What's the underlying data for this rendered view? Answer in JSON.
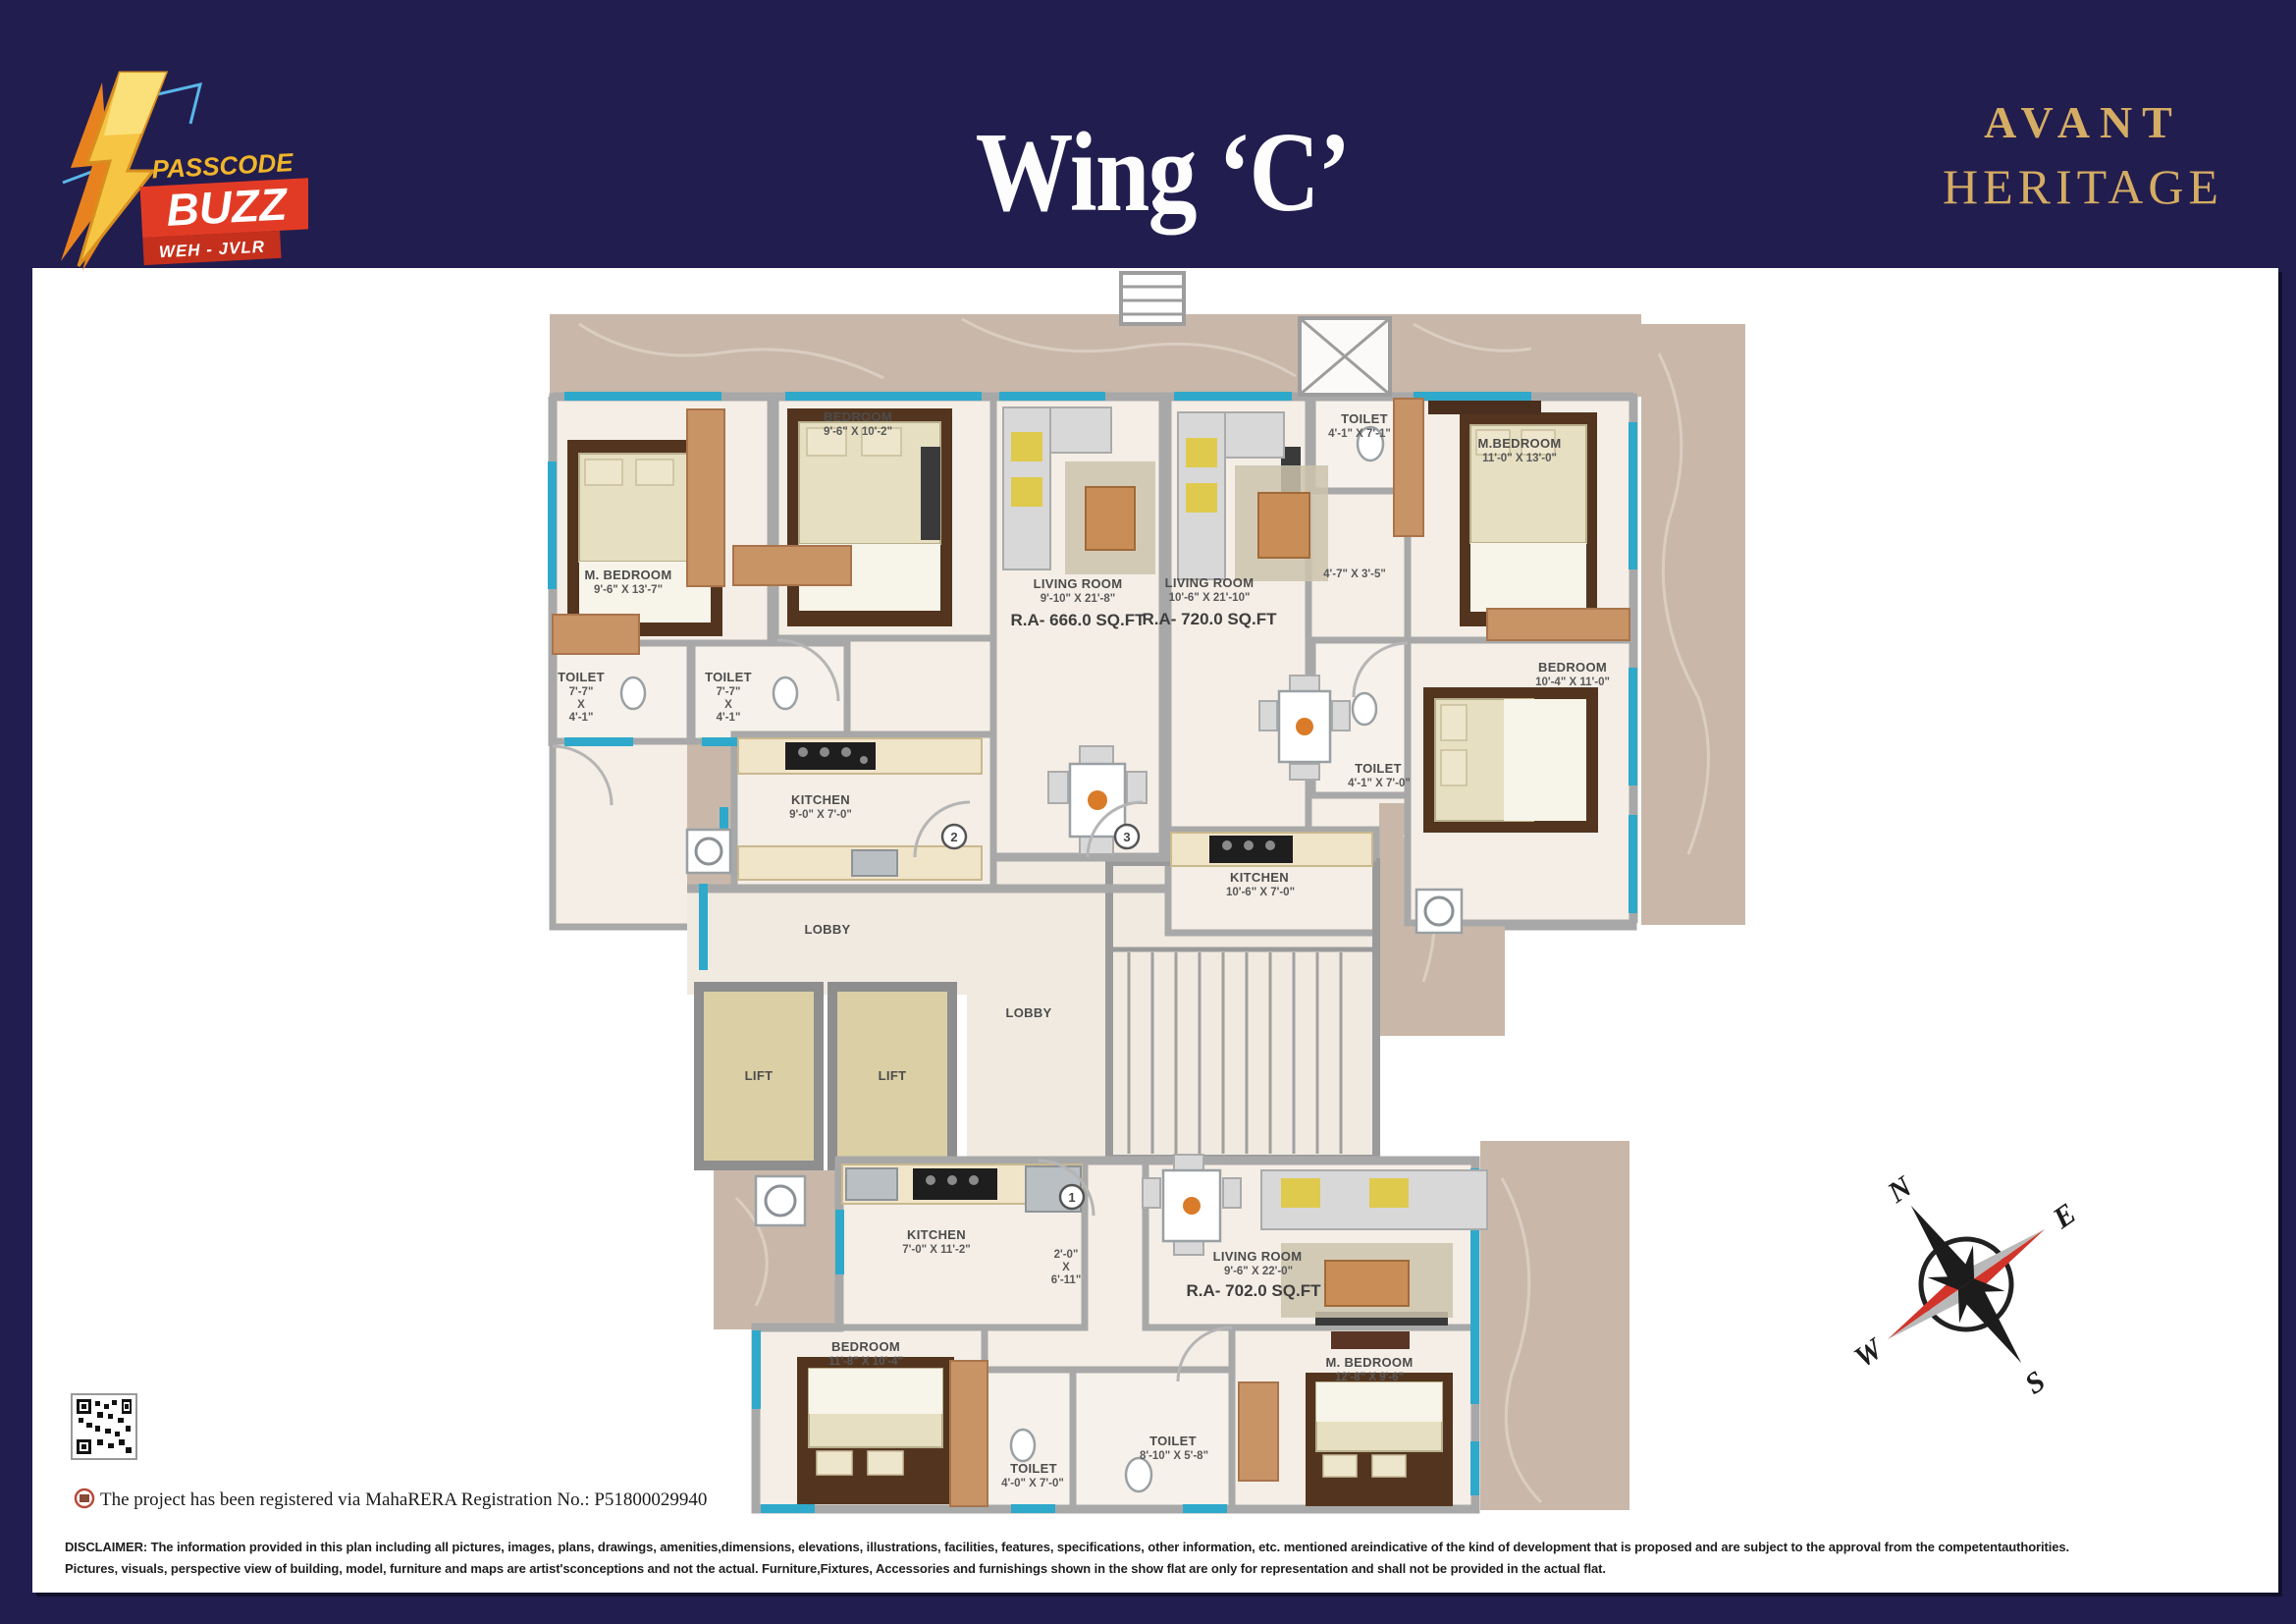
{
  "header": {
    "logo": {
      "passcode": "PASSCODE",
      "buzz": "BUZZ",
      "weh": "WEH - JVLR"
    },
    "title": "Wing ‘C’",
    "brand": {
      "avant": "AVANT",
      "heritage": "HERITAGE"
    }
  },
  "floorplan": {
    "rooms": {
      "m_bedroom_a": {
        "label": "M. BEDROOM",
        "dim": "9'-6\" X 13'-7\""
      },
      "bedroom_a": {
        "label": "BEDROOM",
        "dim": "9'-6\" X 10'-2\""
      },
      "living_a": {
        "label": "LIVING ROOM",
        "dim": "9'-10\" X 21'-8\"",
        "area": "R.A- 666.0 SQ.FT"
      },
      "toilet_a1": {
        "label": "TOILET",
        "w": "7'-7\"",
        "x": "X",
        "h": "4'-1\""
      },
      "toilet_a2": {
        "label": "TOILET",
        "w": "7'-7\"",
        "x": "X",
        "h": "4'-1\""
      },
      "kitchen_a": {
        "label": "KITCHEN",
        "dim": "9'-0\" X 7'-0\""
      },
      "living_b": {
        "label": "LIVING ROOM",
        "dim": "10'-6\" X 21'-10\"",
        "area": "R.A- 720.0 SQ.FT"
      },
      "toilet_b1": {
        "label": "TOILET",
        "dim": "4'-1\" X 7'-1\""
      },
      "passage_b": {
        "dim": "4'-7\" X 3'-5\""
      },
      "m_bedroom_b": {
        "label": "M.BEDROOM",
        "dim": "11'-0\" X 13'-0\""
      },
      "bedroom_b": {
        "label": "BEDROOM",
        "dim": "10'-4\" X 11'-0\""
      },
      "toilet_b2": {
        "label": "TOILET",
        "dim": "4'-1\" X 7'-0\""
      },
      "kitchen_b": {
        "label": "KITCHEN",
        "dim": "10'-6\" X 7'-0\""
      },
      "lobby_a": {
        "label": "LOBBY"
      },
      "lobby_b": {
        "label": "LOBBY"
      },
      "lift_1": {
        "label": "LIFT"
      },
      "lift_2": {
        "label": "LIFT"
      },
      "kitchen_c": {
        "label": "KITCHEN",
        "dim": "7'-0\" X 11'-2\""
      },
      "passage_c": {
        "w": "2'-0\"",
        "x": "X",
        "h": "6'-11\""
      },
      "living_c": {
        "label": "LIVING ROOM",
        "dim": "9'-6\" X 22'-0\"",
        "area": "R.A- 702.0 SQ.FT"
      },
      "bedroom_c": {
        "label": "BEDROOM",
        "dim": "11'-8\" X 10'-4\""
      },
      "toilet_c1": {
        "label": "TOILET",
        "dim": "4'-0\" X 7'-0\""
      },
      "toilet_c2": {
        "label": "TOILET",
        "dim": "8'-10\" X 5'-8\""
      },
      "m_bedroom_c": {
        "label": "M. BEDROOM",
        "dim": "12'-8\" X 9'-6\""
      }
    },
    "door_markers": {
      "d1": "1",
      "d2": "2",
      "d3": "3"
    },
    "compass": {
      "n": "N",
      "e": "E",
      "s": "S",
      "w": "W"
    }
  },
  "footer": {
    "rera": "The project has been registered via MahaRERA Registration No.: P51800029940",
    "disclaimer_1": "DISCLAIMER: The information provided in this plan including all pictures, images, plans, drawings, amenities,dimensions, elevations, illustrations, facilities, features, specifications, other information, etc. mentioned areindicative of the kind of development that is proposed and are subject to the approval from the competentauthorities.",
    "disclaimer_2": "Pictures, visuals, perspective view of building, model, furniture and maps are artist'sconceptions and not the actual. Furniture,Fixtures, Accessories and furnishings shown in the show flat are only for representation and shall not be provided in the actual flat."
  },
  "colors": {
    "navy": "#221d4f",
    "gold": "#d4ac63",
    "cyan": "#2fa9cb",
    "red": "#e23b25"
  }
}
